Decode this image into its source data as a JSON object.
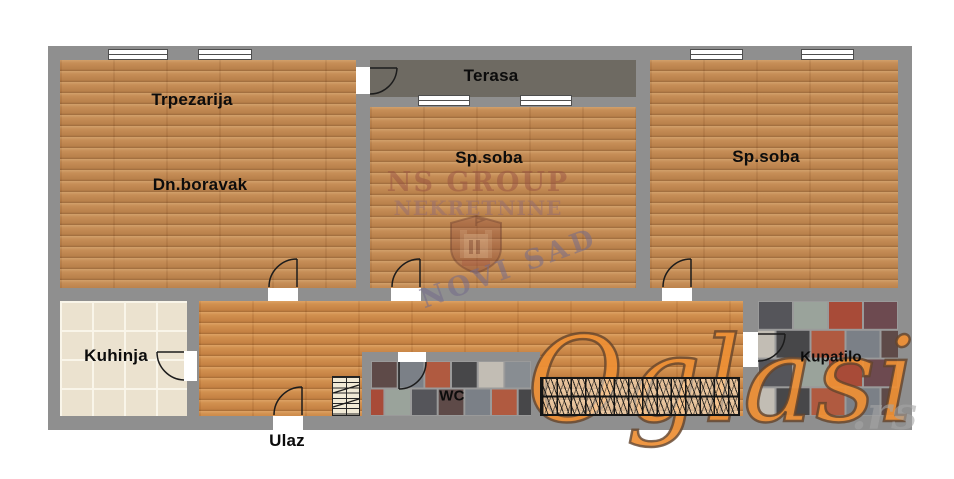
{
  "rooms": {
    "living1": {
      "label": "Trpezarija"
    },
    "living2": {
      "label": "Dn.boravak"
    },
    "terrace": {
      "label": "Terasa"
    },
    "bedroom1": {
      "label": "Sp.soba"
    },
    "bedroom2": {
      "label": "Sp.soba"
    },
    "kitchen": {
      "label": "Kuhinja"
    },
    "wc": {
      "label": "WC"
    },
    "bathroom": {
      "label": "Kupatilo"
    },
    "entrance": {
      "label": "Ulaz"
    }
  },
  "watermarks": {
    "agency": {
      "line1": "NS GROUP",
      "line2": "NEKRETNINE",
      "city": "NOVI SAD"
    },
    "site": {
      "name": "Oglasi",
      "tld": ".rs"
    }
  },
  "colors": {
    "wall": "#8f8f8f",
    "wood": "#c68e57",
    "kitchen_tile": "#ebe2cf",
    "terrace_tile": "#6e6a62",
    "grout": "#9a9a9a",
    "watermark_orange": "#ee9035",
    "bath_palette": [
      "#55555a",
      "#9aa39b",
      "#a84b38",
      "#6d4a50",
      "#888d92",
      "#c2bdb4",
      "#474749",
      "#b05a40",
      "#7b8087",
      "#5e4a48"
    ]
  }
}
